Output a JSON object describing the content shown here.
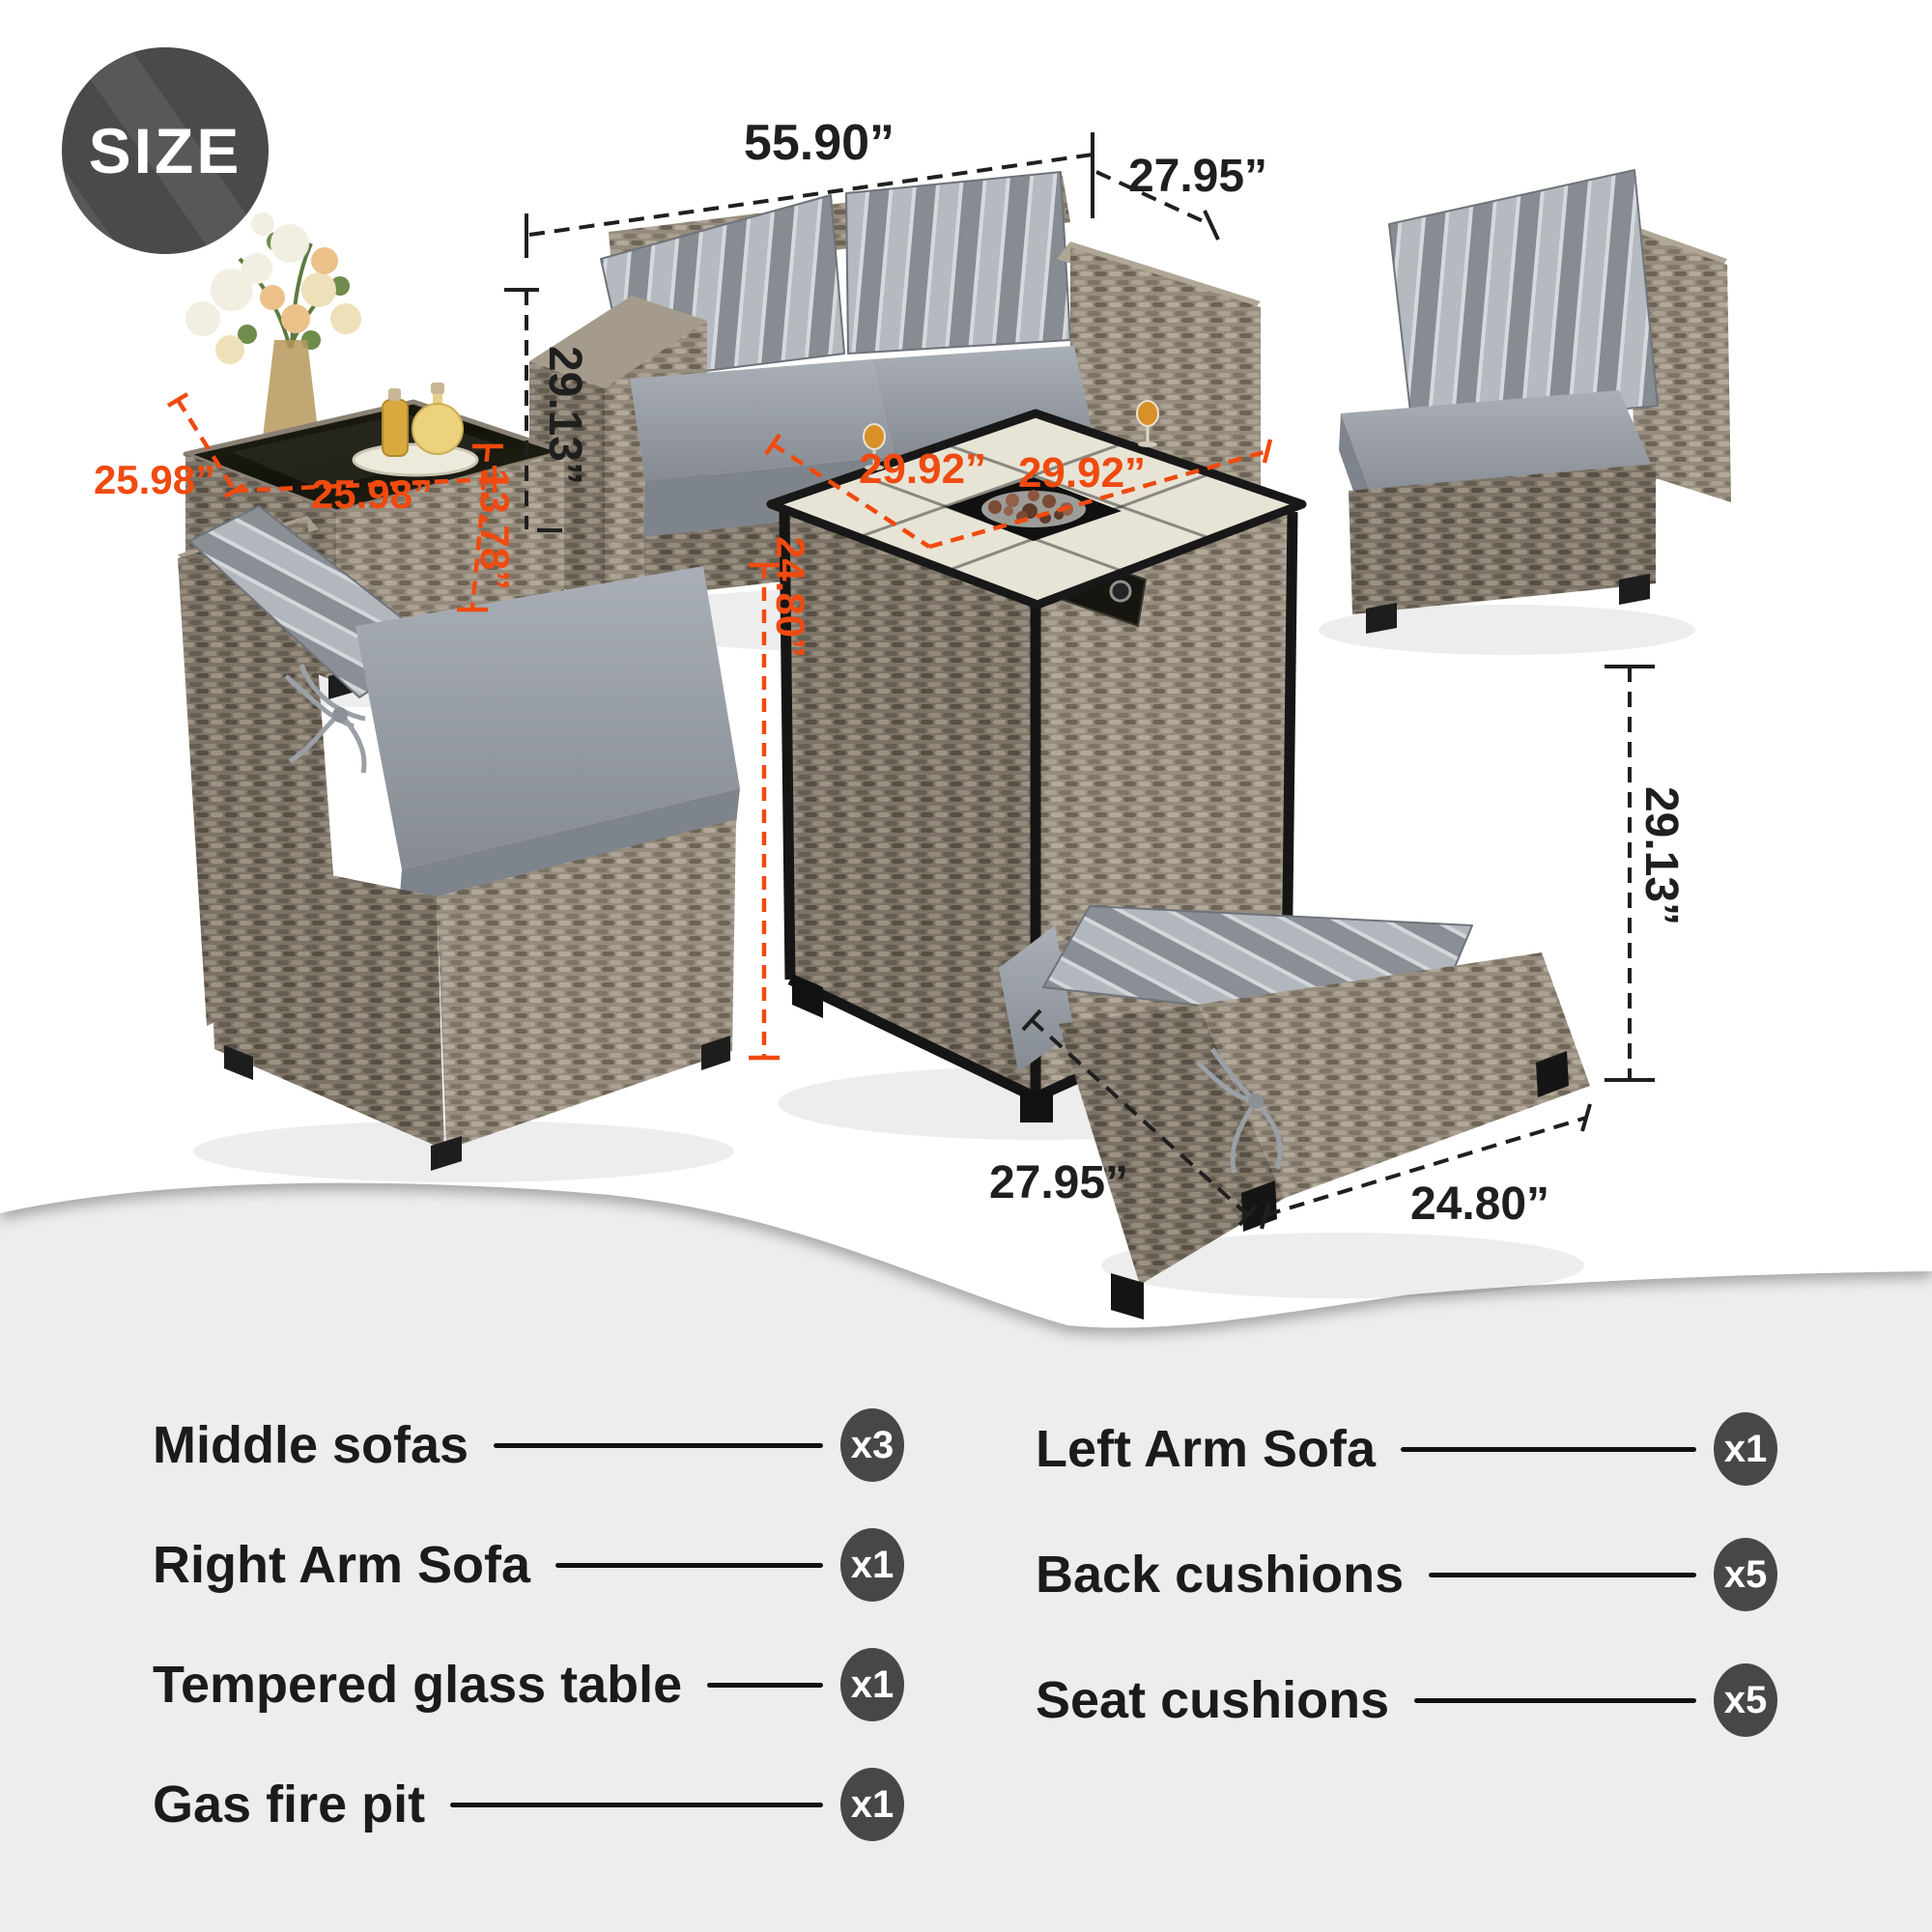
{
  "badge": {
    "label": "SIZE"
  },
  "colors": {
    "accent-orange": "#f04a10",
    "dim-text": "#1f1f1f",
    "badge-bg": "#4a4a4a",
    "count-badge-bg": "#474747",
    "footer-bg": "#ededed",
    "list-text": "#1b1b1b"
  },
  "dims": {
    "sofa_width": "55.90”",
    "sofa_depth": "27.95”",
    "sofa_height": "29.13”",
    "side_table_depth": "25.98”",
    "side_table_width": "25.98”",
    "side_table_height": "13.78”",
    "fire_pit_depth": "29.92”",
    "fire_pit_width": "29.92”",
    "fire_pit_height": "24.80”",
    "chair_width": "27.95”",
    "chair_depth": "24.80”",
    "chair_height": "29.13”"
  },
  "parts_list": {
    "columns": [
      {
        "items": [
          {
            "label": "Middle sofas",
            "count": "x3"
          },
          {
            "label": "Right Arm Sofa",
            "count": "x1"
          },
          {
            "label": "Tempered glass table",
            "count": "x1"
          },
          {
            "label": "Gas fire pit",
            "count": "x1"
          }
        ]
      },
      {
        "items": [
          {
            "label": "Left Arm Sofa",
            "count": "x1"
          },
          {
            "label": "Back cushions",
            "count": "x5"
          },
          {
            "label": "Seat cushions",
            "count": "x5"
          }
        ]
      }
    ]
  }
}
